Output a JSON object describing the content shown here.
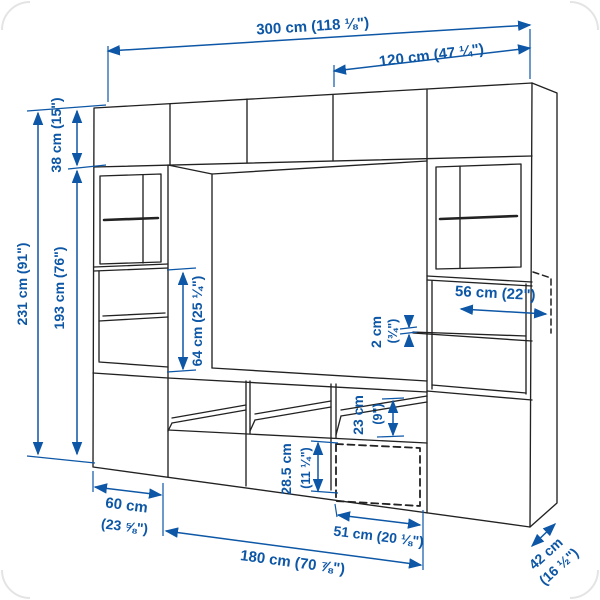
{
  "diagram": {
    "kind": "furniture dimension line drawing",
    "subject": "TV storage wall unit with glass doors, open shelves and drawers",
    "view": "perspective front-right view",
    "units_shown": "centimeters with inches in parentheses"
  },
  "colors": {
    "dimension_blue": "#0d57a6",
    "line_dark": "#222222",
    "background": "#ffffff"
  },
  "dims": {
    "total_width": "300 cm (118 ⅛\")",
    "upper_right_width": "120 cm (47 ¼\")",
    "total_height": "231 cm (91\")",
    "top_row_height": "38 cm (15\")",
    "frame_height": "193 cm (76\")",
    "open_compartment_height": "64 cm (25 ¼\")",
    "shelf_depth": "56 cm (22\")",
    "shelf_thickness_cm": "2 cm",
    "shelf_thickness_in": "(¾\")",
    "media_compartment_height_cm": "23 cm",
    "media_compartment_height_in": "(9\")",
    "drawer_front_height_cm": "28.5 cm",
    "drawer_front_height_in": "(11 ¼\")",
    "side_cabinet_width_cm": "60 cm",
    "side_cabinet_width_in": "(23 ⅝\")",
    "tv_bench_width": "180 cm (70 ⅞\")",
    "drawer_width": "51 cm (20 ⅛\")",
    "depth_cm": "42 cm",
    "depth_in": "(16 ½\")"
  }
}
